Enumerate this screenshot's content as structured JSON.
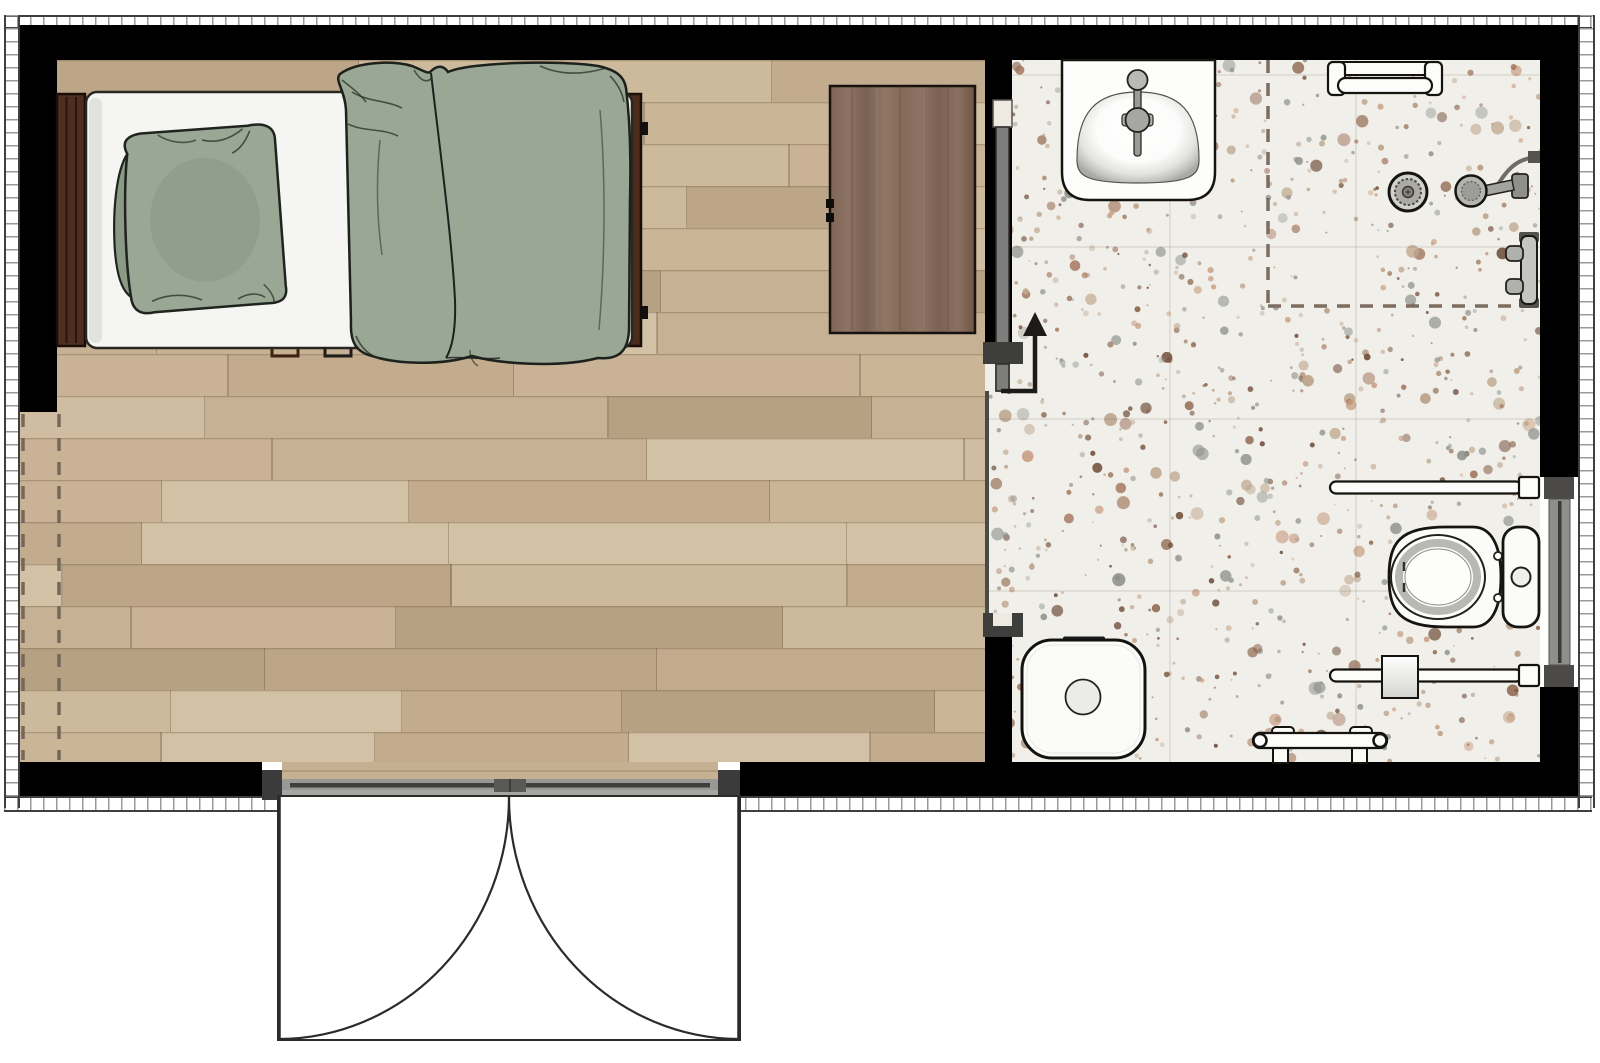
{
  "document": {
    "type": "floor-plan",
    "view": "top-down plan",
    "visible_text": "none"
  },
  "palette": {
    "wall": "#000000",
    "ink": "#201e19",
    "wood_base": "#c8b497",
    "walnut": "#846a5a",
    "terrazzo_base": "#f0efe9",
    "textile": "#9aa795",
    "textile_dark": "#8b9a85",
    "fixture_white": "#fbfbf9",
    "metal": "#b4b4b0",
    "door_leaf": "#7d7d7b",
    "track": "#989895",
    "jamb": "#3b3b3b",
    "dash": "#7c6d60",
    "ruler_line": "#3f3f3f",
    "ruler_tick": "#9a9a9a"
  },
  "rooms": [
    {
      "id": "bedroom",
      "floor": "wood-plank"
    },
    {
      "id": "bathroom",
      "floor": "terrazzo"
    }
  ],
  "fixtures": {
    "bed": {
      "label": "bed"
    },
    "pillow": {
      "label": "pillow"
    },
    "duvet": {
      "label": "duvet"
    },
    "headboard": {
      "label": "headboard"
    },
    "footboard": {
      "label": "footboard"
    },
    "cabinet": {
      "label": "wardrobe-cabinet"
    },
    "pocket_door": {
      "label": "sliding-pocket-door"
    },
    "slide_arrow": {
      "label": "door-slide-direction-arrow"
    },
    "entry_door": {
      "label": "double-entry-door"
    },
    "wall_opening": {
      "label": "dashed-wall-opening"
    },
    "sink": {
      "label": "sink-vanity"
    },
    "towel_rack": {
      "label": "towel-rack"
    },
    "shower": {
      "label": "shower-area-boundary"
    },
    "drain": {
      "label": "shower-drain"
    },
    "hand_shower": {
      "label": "handheld-shower"
    },
    "valve": {
      "label": "shower-valve"
    },
    "toilet": {
      "label": "toilet"
    },
    "grab_bar_upper": {
      "label": "grab-bar"
    },
    "grab_bar_lower": {
      "label": "grab-bar"
    },
    "tp_holder": {
      "label": "toilet-paper-holder"
    },
    "bench": {
      "label": "bench"
    },
    "stool": {
      "label": "stool-side-table"
    },
    "window": {
      "label": "window"
    }
  },
  "textures": {
    "wood": {
      "row_height": 42,
      "seed": 7,
      "plank_min": 200,
      "plank_max": 430,
      "shades": [
        "#cdb99c",
        "#c6b194",
        "#d0bda1",
        "#c2ac8d",
        "#cab697",
        "#bca687",
        "#d3c1a6",
        "#c9b296",
        "#b7a183"
      ]
    },
    "terrazzo": {
      "seed": 11,
      "dots": 980,
      "speckles": [
        "#a1745b",
        "#8a6046",
        "#c89e83",
        "#9a9c96",
        "#b99f85",
        "#6e4c38",
        "#c0a88e",
        "#8f918d"
      ]
    }
  }
}
